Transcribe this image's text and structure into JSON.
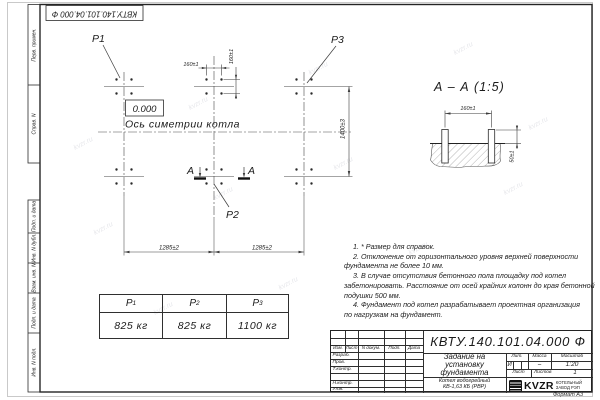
{
  "watermark": {
    "text": "kvzr.ru"
  },
  "frame": {
    "doc_number_rotated": "КВТУ.140.101.04.000 Ф",
    "format_label": "Формат А3",
    "margin_labels": {
      "perv": "Перв. примен.",
      "sprav": "Справ. N",
      "podp1": "Подп. и дата",
      "inv_dubl": "Инв. N дубл.",
      "vzam": "Взам. инв. N",
      "podp2": "Подп. и дата",
      "inv_podl": "Инв. N подл."
    }
  },
  "plan": {
    "p1": "P1",
    "p2": "P2",
    "p3": "P3",
    "elevation": "0.000",
    "axis_label": "Ось симетрии котла",
    "dim_160_h": "160±1",
    "dim_160_v": "160±1",
    "dim_1285_left": "1285±2",
    "dim_1285_right": "1285±2",
    "dim_1400": "1400±3",
    "section_letter_left": "А",
    "section_letter_right": "А"
  },
  "section_view": {
    "title": "А – А (1:5)",
    "dim_160": "160±1",
    "dim_50": "50±1"
  },
  "note_lines": [
    "1. * Размер для справок.",
    "2. Отклонение от горизонтального уровня верхней поверхности",
    "фундамента не более 10 мм.",
    "3. В случае отсутствия бетонного пола площадку под котел",
    "забетонировать. Расстояние от осей крайних колонн до края бетонной",
    "подушки 500 мм.",
    "4. Фундамент под котел разрабатывает проектная организация",
    "по нагрузкам на фундамент."
  ],
  "load_table": {
    "headers": [
      {
        "sym": "Р",
        "sub": "1"
      },
      {
        "sym": "Р",
        "sub": "2"
      },
      {
        "sym": "Р",
        "sub": "3"
      }
    ],
    "values": [
      "825 кг",
      "825 кг",
      "1100 кг"
    ]
  },
  "title_block": {
    "doc_number": "КВТУ.140.101.04.000 Ф",
    "title_line1": "Задание на",
    "title_line2": "установку",
    "title_line3": "фундамента",
    "product_line1": "Котел водогрейный",
    "product_line2": "КВ-1,63 КБ (РВР)",
    "header_izm": "Изм.",
    "header_list": "Лист",
    "header_doc": "N докум.",
    "header_podp": "Подп.",
    "header_data": "Дата",
    "row_razrab": "Разраб.",
    "row_prov": "Пров.",
    "row_tkontr": "Т.контр.",
    "row_nkontr": "Н.контр.",
    "row_utv": "Утв.",
    "lit_label": "Лит.",
    "lit_value": "И",
    "mass_label": "Масса",
    "mass_value": "–",
    "scale_label": "Масштаб",
    "scale_value": "1:20",
    "sheet_label": "Лист",
    "sheets_label": "Листов",
    "sheets_value": "1",
    "logo_text": "KVZR",
    "company_line1": "КОТЕЛЬНЫЙ",
    "company_line2": "ЗАВОД РЭП"
  }
}
